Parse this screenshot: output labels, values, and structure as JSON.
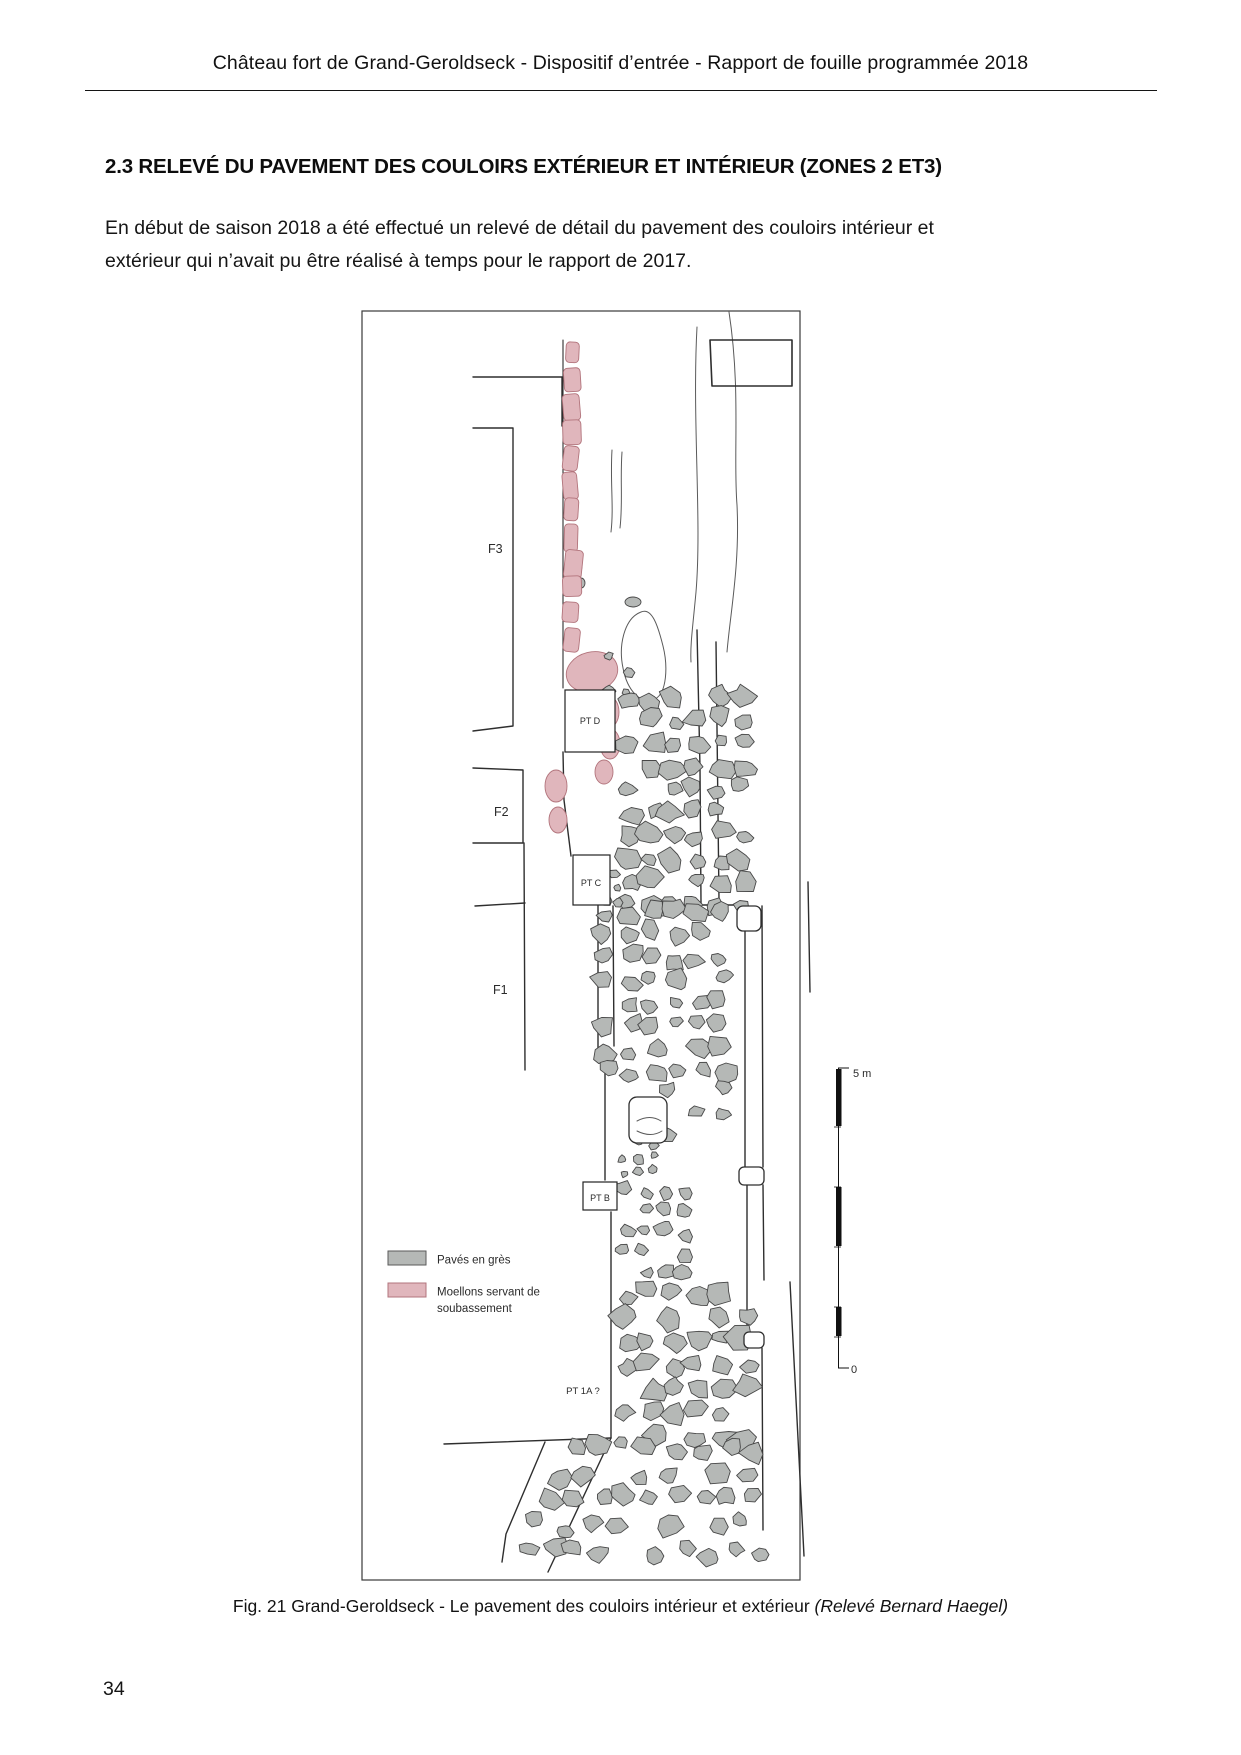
{
  "header": {
    "text": "Château fort de Grand-Geroldseck - Dispositif d’entrée - Rapport de fouille programmée 2018"
  },
  "section_title": "2.3 RELEVÉ DU PAVEMENT DES COULOIRS EXTÉRIEUR ET INTÉRIEUR (ZONES 2 ET3)",
  "paragraph": {
    "lines": [
      "En début de saison 2018 a été effectué un relevé de détail  du pavement des couloirs intérieur et",
      "extérieur qui n’avait pu être réalisé à temps pour le rapport de 2017."
    ]
  },
  "figure": {
    "labels": {
      "f3": "F3",
      "f2": "F2",
      "f1": "F1",
      "pt_d": "PT D",
      "pt_c": "PT C",
      "pt_b": "PT B",
      "pt_1a": "PT 1A ?"
    },
    "legend": [
      {
        "label": "Pavés en grès",
        "color": "#b5b8b6"
      },
      {
        "label": "Moellons servant de soubassement",
        "lines": [
          "Moellons servant de",
          "soubassement"
        ],
        "color": "#e0b6bc"
      }
    ],
    "scale": {
      "top": "5 m",
      "bottom": "0"
    },
    "colors": {
      "paves": "#b5b8b6",
      "moellons": "#e0b6bc",
      "wall_line": "#2e2e2e"
    }
  },
  "caption": {
    "text": "Fig. 21 Grand-Geroldseck - Le pavement des couloirs intérieur et extérieur ",
    "credit": "(Relevé Bernard Haegel)"
  },
  "page_number": "34"
}
